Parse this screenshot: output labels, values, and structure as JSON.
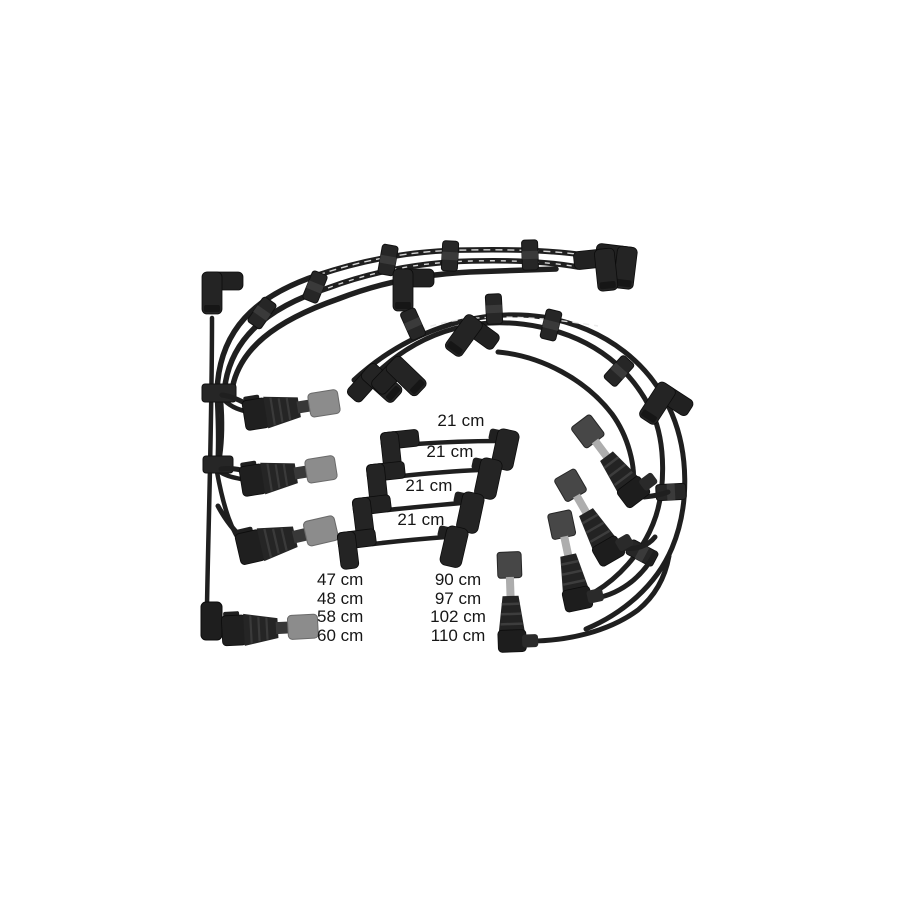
{
  "photo": {
    "description": "Ignition lead (spark plug wire) kit product photo on white background",
    "colors": {
      "background": "#ffffff",
      "cable": "#1f1f1f",
      "boot": "#232323",
      "gray_tip": "#8c8c8c",
      "metal_shaft": "#adadad",
      "text": "#161616"
    }
  },
  "labels": {
    "short_leads": [
      "21 cm",
      "21 cm",
      "21 cm",
      "21 cm"
    ],
    "left_column": [
      "47 cm",
      "48 cm",
      "58 cm",
      "60 cm"
    ],
    "right_column": [
      "90 cm",
      "97 cm",
      "102 cm",
      "110 cm"
    ]
  }
}
